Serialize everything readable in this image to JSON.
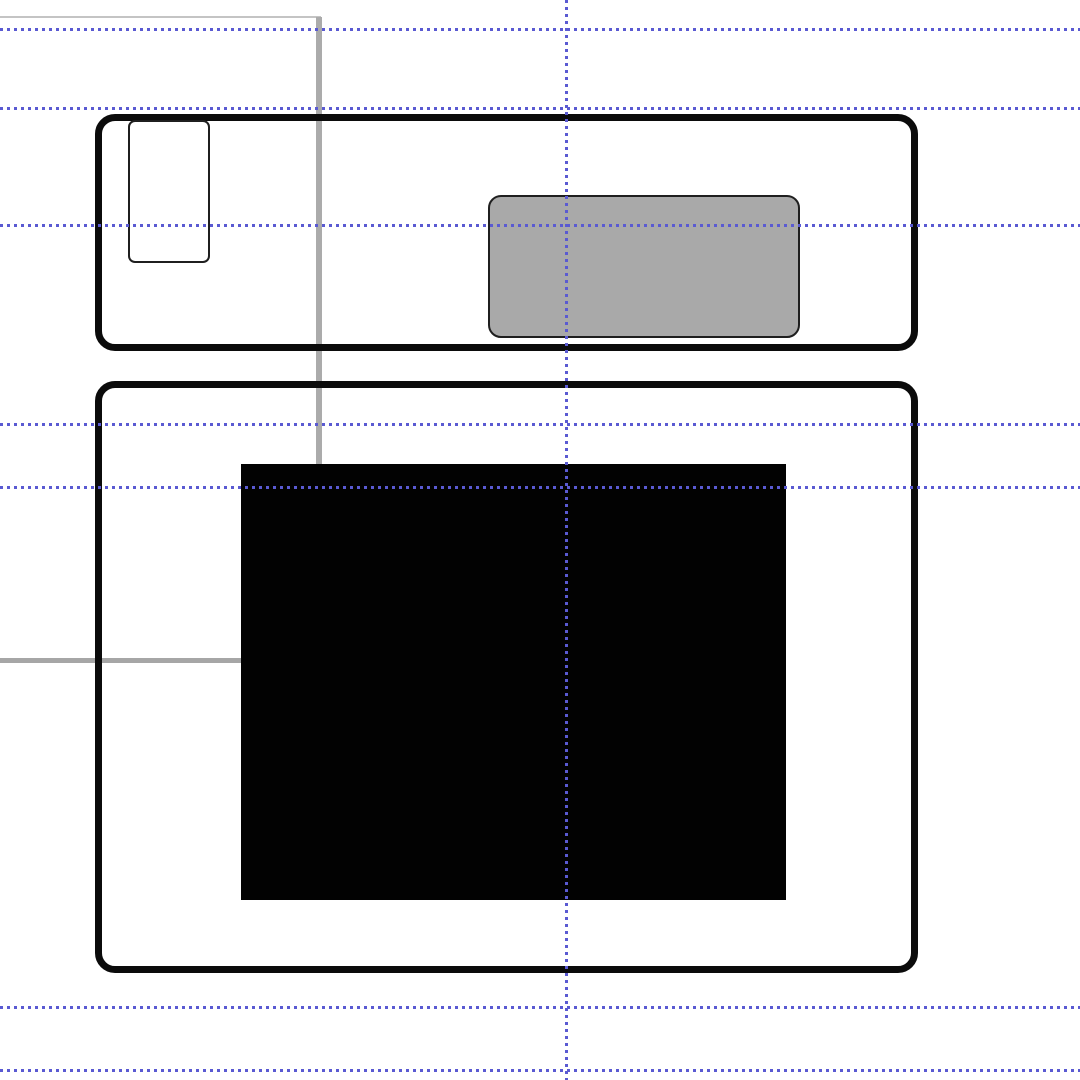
{
  "canvas": {
    "width": 1080,
    "height": 1080,
    "background": "#ffffff",
    "colors": {
      "guide": "#5a5ad2",
      "panel_outline": "#0b0b0b",
      "inner_outline": "#1f1f1f",
      "gray_fill": "#a9a9a9",
      "black_fill": "#020202",
      "construction_light": "#c4c4c4",
      "construction_mid": "#ababab"
    },
    "guides": {
      "horizontal": [
        29,
        108,
        225,
        424,
        487,
        1007,
        1070
      ],
      "vertical": [
        566
      ]
    },
    "construction_lines": [
      {
        "id": "clipped-rect-top-edge",
        "x": 0,
        "y": 16,
        "w": 321,
        "h": 2,
        "color": "#c4c4c4"
      },
      {
        "id": "clipped-rect-right-edge",
        "x": 316,
        "y": 17,
        "w": 6,
        "h": 447,
        "color": "#ababab"
      },
      {
        "id": "clipped-rect-bottom-edge",
        "x": 0,
        "y": 658,
        "w": 243,
        "h": 5,
        "color": "#a6a6a6"
      }
    ],
    "shapes": [
      {
        "id": "top-panel-fill",
        "x": 95,
        "y": 114,
        "w": 823,
        "h": 237,
        "radius": 20,
        "fill": "#ffffff",
        "stroke": "none",
        "strokeWidth": 0,
        "z": 1
      },
      {
        "id": "bottom-panel-fill",
        "x": 95,
        "y": 381,
        "w": 823,
        "h": 592,
        "radius": 20,
        "fill": "#ffffff",
        "stroke": "none",
        "strokeWidth": 0,
        "z": 1
      },
      {
        "id": "top-panel-border",
        "x": 95,
        "y": 114,
        "w": 823,
        "h": 237,
        "radius": 20,
        "fill": "none",
        "stroke": "#0b0b0b",
        "strokeWidth": 7,
        "z": 3
      },
      {
        "id": "bottom-panel-border",
        "x": 95,
        "y": 381,
        "w": 823,
        "h": 592,
        "radius": 20,
        "fill": "none",
        "stroke": "#0b0b0b",
        "strokeWidth": 7,
        "z": 3
      },
      {
        "id": "small-outlined-card",
        "x": 128,
        "y": 120,
        "w": 82,
        "h": 143,
        "radius": 7,
        "fill": "#ffffff",
        "stroke": "#1f1f1f",
        "strokeWidth": 2,
        "z": 4
      },
      {
        "id": "gray-rounded-block",
        "x": 488,
        "y": 195,
        "w": 312,
        "h": 143,
        "radius": 13,
        "fill": "#a9a9a9",
        "stroke": "#1f1f1f",
        "strokeWidth": 2,
        "z": 4
      },
      {
        "id": "black-image-block",
        "x": 241,
        "y": 464,
        "w": 545,
        "h": 436,
        "radius": 0,
        "fill": "#020202",
        "stroke": "none",
        "strokeWidth": 0,
        "z": 4
      }
    ]
  }
}
